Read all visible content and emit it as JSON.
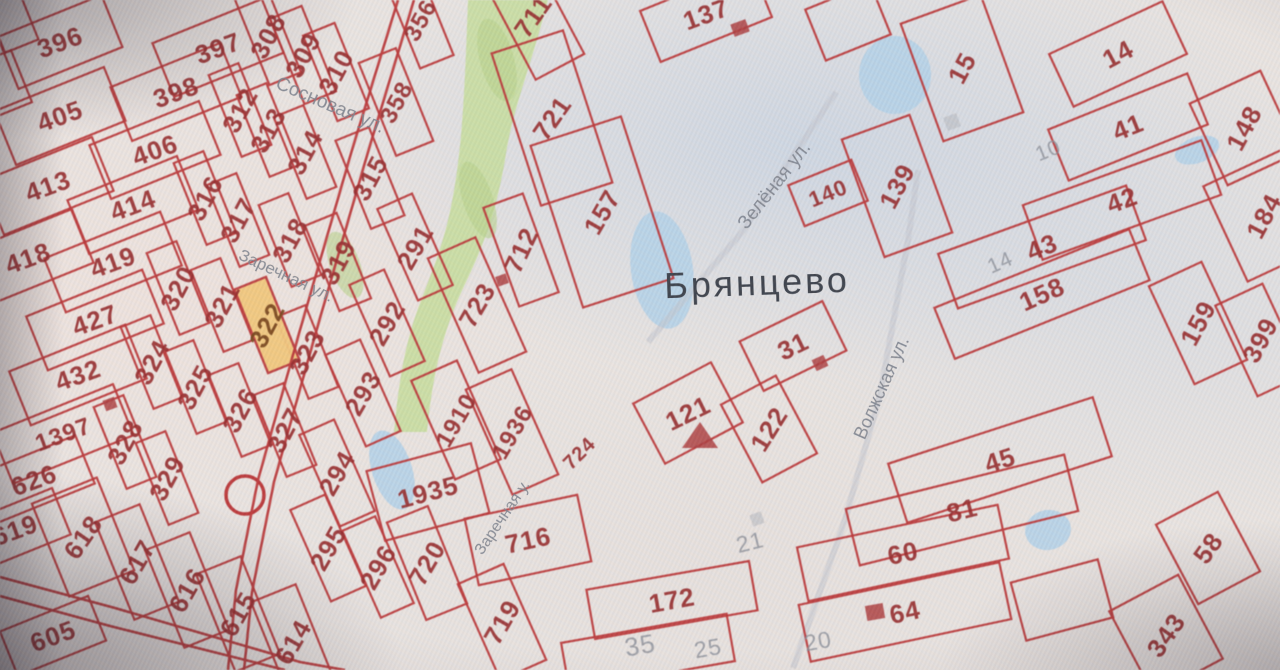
{
  "map": {
    "place_label": "Брянцево",
    "streets": [
      {
        "name": "Сосновая ул.",
        "x": 330,
        "y": 106,
        "rot": 23,
        "fs": 19
      },
      {
        "name": "Заречная ул.",
        "x": 286,
        "y": 276,
        "rot": 25,
        "fs": 17
      },
      {
        "name": "Зелёная ул.",
        "x": 775,
        "y": 186,
        "rot": -52,
        "fs": 19
      },
      {
        "name": "Волжская ул.",
        "x": 882,
        "y": 388,
        "rot": -66,
        "fs": 18
      },
      {
        "name": "Заречная у.",
        "x": 503,
        "y": 518,
        "rot": -56,
        "fs": 16
      }
    ],
    "colors": {
      "line": "#c13a3a",
      "label_red": "#9c2e2e",
      "label_gray": "#8b9099",
      "street": "#7e848d",
      "place": "#3e444c",
      "highlight_fill": "#f4c97a",
      "highlight_label": "#7d4a1c",
      "green": "#c8df9d",
      "green_dark": "#b7d489",
      "pond": "#b5d4e9",
      "road_gray": "#c2c7cd",
      "paper": "#e9e5e1",
      "building": "#b14040"
    },
    "highlighted_parcel": {
      "n": "322",
      "x": 267,
      "y": 325,
      "lr": -62,
      "w": 34,
      "h": 90,
      "rr": -22
    },
    "parcels": [
      {
        "n": "396",
        "x": 60,
        "y": 42,
        "lr": -20,
        "w": 112,
        "h": 56,
        "rr": -22
      },
      {
        "n": "405",
        "x": 60,
        "y": 116,
        "lr": -20,
        "w": 118,
        "h": 58,
        "rr": -22
      },
      {
        "n": "413",
        "x": 48,
        "y": 186,
        "lr": -20,
        "w": 118,
        "h": 58,
        "rr": -22
      },
      {
        "n": "418",
        "x": 28,
        "y": 258,
        "lr": -20,
        "w": 118,
        "h": 58,
        "rr": -22
      },
      {
        "n": "397",
        "x": 218,
        "y": 48,
        "lr": -20,
        "w": 118,
        "h": 58,
        "rr": -22
      },
      {
        "n": "398",
        "x": 176,
        "y": 92,
        "lr": -20,
        "w": 118,
        "h": 58,
        "rr": -22
      },
      {
        "n": "406",
        "x": 155,
        "y": 150,
        "lr": -20,
        "w": 118,
        "h": 58,
        "rr": -22
      },
      {
        "n": "414",
        "x": 133,
        "y": 205,
        "lr": -20,
        "w": 118,
        "h": 58,
        "rr": -22
      },
      {
        "n": "419",
        "x": 113,
        "y": 262,
        "lr": -20,
        "w": 125,
        "h": 58,
        "rr": -22
      },
      {
        "n": "427",
        "x": 95,
        "y": 320,
        "lr": -20,
        "w": 125,
        "h": 58,
        "rr": -22
      },
      {
        "n": "432",
        "x": 78,
        "y": 375,
        "lr": -20,
        "w": 125,
        "h": 58,
        "rr": -22
      },
      {
        "n": "1397",
        "x": 63,
        "y": 434,
        "lr": -20,
        "w": 130,
        "h": 55,
        "rr": -22,
        "fs": 24
      },
      {
        "n": "626",
        "x": 34,
        "y": 480,
        "lr": -20,
        "w": 110,
        "h": 52,
        "rr": -22
      },
      {
        "n": "619",
        "x": 15,
        "y": 530,
        "lr": -20,
        "w": 100,
        "h": 50,
        "rr": -22
      },
      {
        "n": "618",
        "x": 83,
        "y": 537,
        "lr": -55,
        "w": 70,
        "h": 100,
        "rr": -22
      },
      {
        "n": "617",
        "x": 137,
        "y": 562,
        "lr": -60,
        "w": 48,
        "h": 105,
        "rr": -22
      },
      {
        "n": "616",
        "x": 187,
        "y": 590,
        "lr": -60,
        "w": 48,
        "h": 105,
        "rr": -22
      },
      {
        "n": "615",
        "x": 238,
        "y": 614,
        "lr": -60,
        "w": 48,
        "h": 105,
        "rr": -22
      },
      {
        "n": "614",
        "x": 293,
        "y": 642,
        "lr": -60,
        "w": 48,
        "h": 105,
        "rr": -22
      },
      {
        "n": "605",
        "x": 53,
        "y": 636,
        "lr": -20,
        "w": 95,
        "h": 48,
        "rr": -22
      },
      {
        "n": "308",
        "x": 268,
        "y": 36,
        "lr": -62,
        "w": 34,
        "h": 92,
        "rr": -22
      },
      {
        "n": "309",
        "x": 303,
        "y": 55,
        "lr": -62,
        "w": 34,
        "h": 92,
        "rr": -22
      },
      {
        "n": "310",
        "x": 336,
        "y": 72,
        "lr": -62,
        "w": 34,
        "h": 92,
        "rr": -22
      },
      {
        "n": "358",
        "x": 396,
        "y": 102,
        "lr": -62,
        "w": 40,
        "h": 100,
        "rr": -22,
        "fs": 24
      },
      {
        "n": "356",
        "x": 420,
        "y": 20,
        "lr": -62,
        "w": 36,
        "h": 90,
        "rr": -22,
        "fs": 24
      },
      {
        "n": "312",
        "x": 240,
        "y": 110,
        "lr": -62,
        "w": 32,
        "h": 88,
        "rr": -22
      },
      {
        "n": "313",
        "x": 268,
        "y": 130,
        "lr": -62,
        "w": 32,
        "h": 88,
        "rr": -22
      },
      {
        "n": "314",
        "x": 305,
        "y": 152,
        "lr": -62,
        "w": 32,
        "h": 88,
        "rr": -22
      },
      {
        "n": "315",
        "x": 370,
        "y": 178,
        "lr": -62,
        "w": 36,
        "h": 95,
        "rr": -22
      },
      {
        "n": "316",
        "x": 205,
        "y": 198,
        "lr": -62,
        "w": 32,
        "h": 88,
        "rr": -22
      },
      {
        "n": "317",
        "x": 238,
        "y": 220,
        "lr": -62,
        "w": 32,
        "h": 88,
        "rr": -22
      },
      {
        "n": "318",
        "x": 290,
        "y": 240,
        "lr": -62,
        "w": 32,
        "h": 88,
        "rr": -22
      },
      {
        "n": "319",
        "x": 338,
        "y": 262,
        "lr": -62,
        "w": 34,
        "h": 92,
        "rr": -22
      },
      {
        "n": "320",
        "x": 178,
        "y": 288,
        "lr": -62,
        "w": 32,
        "h": 88,
        "rr": -22
      },
      {
        "n": "321",
        "x": 222,
        "y": 305,
        "lr": -62,
        "w": 32,
        "h": 88,
        "rr": -22
      },
      {
        "n": "323",
        "x": 307,
        "y": 352,
        "lr": -62,
        "w": 32,
        "h": 88,
        "rr": -22
      },
      {
        "n": "324",
        "x": 152,
        "y": 362,
        "lr": -62,
        "w": 32,
        "h": 88,
        "rr": -22
      },
      {
        "n": "325",
        "x": 195,
        "y": 387,
        "lr": -62,
        "w": 32,
        "h": 88,
        "rr": -22
      },
      {
        "n": "326",
        "x": 240,
        "y": 410,
        "lr": -62,
        "w": 32,
        "h": 88,
        "rr": -22
      },
      {
        "n": "327",
        "x": 285,
        "y": 430,
        "lr": -62,
        "w": 32,
        "h": 88,
        "rr": -22
      },
      {
        "n": "328",
        "x": 125,
        "y": 442,
        "lr": -62,
        "w": 32,
        "h": 88,
        "rr": -22
      },
      {
        "n": "329",
        "x": 167,
        "y": 478,
        "lr": -62,
        "w": 32,
        "h": 88,
        "rr": -22
      },
      {
        "n": "291",
        "x": 415,
        "y": 247,
        "lr": -60,
        "w": 38,
        "h": 100,
        "rr": -24
      },
      {
        "n": "292",
        "x": 387,
        "y": 323,
        "lr": -60,
        "w": 38,
        "h": 100,
        "rr": -24
      },
      {
        "n": "293",
        "x": 363,
        "y": 393,
        "lr": -60,
        "w": 38,
        "h": 100,
        "rr": -24
      },
      {
        "n": "294",
        "x": 337,
        "y": 473,
        "lr": -60,
        "w": 38,
        "h": 100,
        "rr": -24
      },
      {
        "n": "295",
        "x": 328,
        "y": 548,
        "lr": -60,
        "w": 38,
        "h": 100,
        "rr": -24
      },
      {
        "n": "296",
        "x": 378,
        "y": 567,
        "lr": -60,
        "w": 36,
        "h": 95,
        "rr": -24
      },
      {
        "n": "711",
        "x": 533,
        "y": 16,
        "lr": -55,
        "w": 55,
        "h": 115,
        "rr": -28
      },
      {
        "n": "721",
        "x": 552,
        "y": 118,
        "lr": -55,
        "w": 75,
        "h": 160,
        "rr": -18
      },
      {
        "n": "712",
        "x": 521,
        "y": 250,
        "lr": -65,
        "w": 42,
        "h": 105,
        "rr": -20
      },
      {
        "n": "157",
        "x": 602,
        "y": 212,
        "lr": -60,
        "w": 95,
        "h": 170,
        "rr": -18
      },
      {
        "n": "723",
        "x": 477,
        "y": 305,
        "lr": -60,
        "w": 52,
        "h": 125,
        "rr": -24
      },
      {
        "n": "1910",
        "x": 456,
        "y": 420,
        "lr": -60,
        "w": 50,
        "h": 108,
        "rr": -24,
        "fs": 24
      },
      {
        "n": "1936",
        "x": 512,
        "y": 432,
        "lr": -60,
        "w": 50,
        "h": 115,
        "rr": -24,
        "fs": 24
      },
      {
        "n": "1935",
        "x": 428,
        "y": 492,
        "lr": -15,
        "w": 108,
        "h": 72,
        "rr": -15
      },
      {
        "n": "720",
        "x": 427,
        "y": 563,
        "lr": -60,
        "w": 44,
        "h": 105,
        "rr": -22
      },
      {
        "n": "716",
        "x": 528,
        "y": 540,
        "lr": -12,
        "w": 115,
        "h": 68,
        "rr": -12
      },
      {
        "n": "719",
        "x": 502,
        "y": 622,
        "lr": -60,
        "w": 50,
        "h": 105,
        "rr": -24
      },
      {
        "n": "724",
        "x": 579,
        "y": 453,
        "lr": -45,
        "fs": 20
      },
      {
        "n": "137",
        "x": 706,
        "y": 14,
        "lr": -20,
        "w": 120,
        "h": 55,
        "rr": -22
      },
      {
        "n": "140",
        "x": 828,
        "y": 193,
        "lr": -22,
        "w": 68,
        "h": 44,
        "rr": -22,
        "fs": 22
      },
      {
        "n": "139",
        "x": 897,
        "y": 186,
        "lr": -62,
        "w": 72,
        "h": 125,
        "rr": -20
      },
      {
        "n": "15",
        "x": 962,
        "y": 68,
        "lr": -62,
        "w": 85,
        "h": 125,
        "rr": -20
      },
      {
        "n": "14",
        "x": 1118,
        "y": 54,
        "lr": -28,
        "w": 125,
        "h": 58,
        "rr": -25
      },
      {
        "n": "41",
        "x": 1128,
        "y": 127,
        "lr": -22,
        "w": 150,
        "h": 55,
        "rr": -22
      },
      {
        "n": "42",
        "x": 1122,
        "y": 200,
        "lr": -20,
        "w": 190,
        "h": 58,
        "rr": -20
      },
      {
        "n": "43",
        "x": 1042,
        "y": 247,
        "lr": -22,
        "w": 200,
        "h": 58,
        "rr": -20
      },
      {
        "n": "158",
        "x": 1042,
        "y": 294,
        "lr": -24,
        "w": 210,
        "h": 55,
        "rr": -22
      },
      {
        "n": "148",
        "x": 1244,
        "y": 128,
        "lr": -62,
        "w": 78,
        "h": 90,
        "rr": -25
      },
      {
        "n": "184",
        "x": 1264,
        "y": 216,
        "lr": -62,
        "w": 85,
        "h": 105,
        "rr": -25
      },
      {
        "n": "159",
        "x": 1198,
        "y": 323,
        "lr": -62,
        "w": 58,
        "h": 108,
        "rr": -25
      },
      {
        "n": "399",
        "x": 1260,
        "y": 340,
        "lr": -62,
        "w": 52,
        "h": 100,
        "rr": -25
      },
      {
        "n": "31",
        "x": 793,
        "y": 346,
        "lr": -26,
        "w": 92,
        "h": 55,
        "rr": -26
      },
      {
        "n": "121",
        "x": 688,
        "y": 413,
        "lr": -26,
        "w": 88,
        "h": 68,
        "rr": -28
      },
      {
        "n": "122",
        "x": 769,
        "y": 429,
        "lr": -58,
        "w": 62,
        "h": 88,
        "rr": -28
      },
      {
        "n": "45",
        "x": 1000,
        "y": 460,
        "lr": -18,
        "w": 215,
        "h": 62,
        "rr": -18
      },
      {
        "n": "81",
        "x": 962,
        "y": 510,
        "lr": -14,
        "w": 225,
        "h": 58,
        "rr": -14
      },
      {
        "n": "60",
        "x": 903,
        "y": 553,
        "lr": -12,
        "w": 205,
        "h": 55,
        "rr": -12
      },
      {
        "n": "64",
        "x": 905,
        "y": 612,
        "lr": -12,
        "w": 205,
        "h": 58,
        "rr": -12
      },
      {
        "n": "172",
        "x": 672,
        "y": 600,
        "lr": -10,
        "w": 165,
        "h": 50,
        "rr": -10
      },
      {
        "n": "58",
        "x": 1208,
        "y": 548,
        "lr": -55,
        "w": 70,
        "h": 90,
        "rr": -28
      },
      {
        "n": "343",
        "x": 1166,
        "y": 635,
        "lr": -55,
        "w": 78,
        "h": 95,
        "rr": -28
      }
    ],
    "unlabeled_boundaries": [
      [
        12,
        22,
        36,
        52,
        -22
      ],
      [
        2,
        84,
        42,
        56,
        -22
      ],
      [
        848,
        22,
        70,
        55,
        -22
      ],
      [
        648,
        652,
        168,
        48,
        -10
      ],
      [
        1062,
        600,
        90,
        60,
        -15
      ]
    ],
    "gray_labels": [
      {
        "n": "10",
        "x": 1048,
        "y": 150,
        "lr": -22,
        "fs": 21
      },
      {
        "n": "14",
        "x": 1000,
        "y": 262,
        "lr": -24,
        "fs": 21
      },
      {
        "n": "21",
        "x": 750,
        "y": 542,
        "lr": -14,
        "fs": 23
      },
      {
        "n": "35",
        "x": 640,
        "y": 645,
        "lr": -10,
        "fs": 26
      },
      {
        "n": "25",
        "x": 708,
        "y": 648,
        "lr": -10,
        "fs": 23
      },
      {
        "n": "20",
        "x": 818,
        "y": 641,
        "lr": -10,
        "fs": 23
      }
    ],
    "gray_squares": [
      [
        952,
        122,
        14
      ],
      [
        757,
        519,
        12
      ]
    ],
    "ponds": [
      {
        "x": 895,
        "y": 75,
        "w": 72,
        "h": 78,
        "r": 0
      },
      {
        "x": 1197,
        "y": 150,
        "w": 46,
        "h": 26,
        "r": -20
      },
      {
        "x": 662,
        "y": 270,
        "w": 62,
        "h": 118,
        "r": -8
      },
      {
        "x": 1048,
        "y": 530,
        "w": 46,
        "h": 40,
        "r": -10
      },
      {
        "x": 392,
        "y": 470,
        "w": 40,
        "h": 82,
        "r": -18
      }
    ],
    "buildings": [
      {
        "x": 740,
        "y": 28,
        "w": 16,
        "h": 13,
        "r": -20
      },
      {
        "x": 820,
        "y": 363,
        "w": 13,
        "h": 12,
        "r": -25
      },
      {
        "x": 875,
        "y": 612,
        "w": 18,
        "h": 15,
        "r": -10
      },
      {
        "x": 110,
        "y": 404,
        "w": 12,
        "h": 11,
        "r": -20
      },
      {
        "x": 502,
        "y": 280,
        "w": 11,
        "h": 10,
        "r": -20
      }
    ],
    "building_triangle": {
      "pts": "682,448 718,448 700,422"
    },
    "circle_feature": {
      "x": 245,
      "y": 495,
      "r": 19
    },
    "roads_red": [
      "398,0 352,150 300,330 258,480 236,590 228,670",
      "414,0 368,152 316,332 274,482 252,592 244,670",
      "0,577 115,608 300,662 345,670",
      "0,596 110,626 285,670"
    ],
    "roads_gray": [
      "648,342 742,232 836,92",
      "793,668 845,520 880,395 908,240 918,170"
    ],
    "green": {
      "band": "M468,0 L548,0 C530,70 512,110 505,160 C492,235 473,265 457,302 C441,340 432,380 427,432 L394,432 C399,378 406,338 422,298 C438,256 450,228 458,163 C464,118 466,55 468,0 Z",
      "patches": [
        {
          "x": 345,
          "y": 265,
          "w": 30,
          "h": 70,
          "r": -20
        },
        {
          "x": 497,
          "y": 60,
          "w": 34,
          "h": 85,
          "r": -15
        },
        {
          "x": 478,
          "y": 200,
          "w": 30,
          "h": 80,
          "r": -18
        }
      ]
    }
  }
}
